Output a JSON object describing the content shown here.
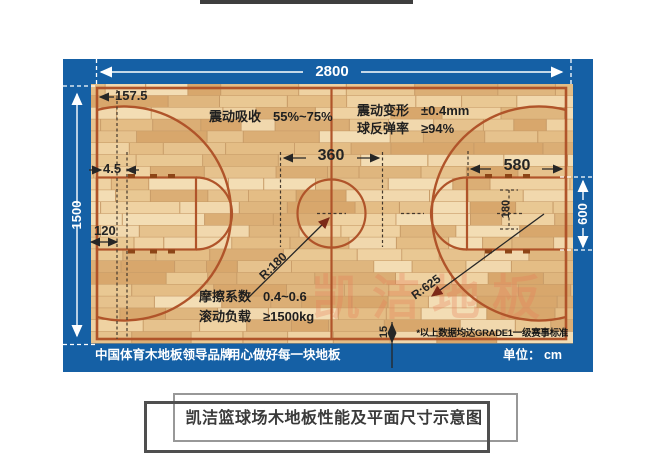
{
  "diagram": {
    "dimensions": {
      "court_length": "2800",
      "court_width": "1500",
      "baseline_to_hoop": "157.5",
      "line_gap": "4.5",
      "hoop_offset": "120",
      "center_circle_diameter": "360",
      "key_length": "580",
      "board_to_hoop": "180",
      "key_width": "600",
      "edge_gap": "15",
      "center_circle_radius": "R:180",
      "three_point_radius": "R:625"
    },
    "specs": [
      {
        "label": "震动吸收",
        "value": "55%~75%"
      },
      {
        "label": "震动变形",
        "value": "±0.4mm"
      },
      {
        "label": "球反弹率",
        "value": "≥94%"
      },
      {
        "label": "摩擦系数",
        "value": "0.4~0.6"
      },
      {
        "label": "滚动负载",
        "value": "≥1500kg"
      }
    ],
    "note": "*以上数据均达GRADE1一级赛事标准",
    "footer": {
      "brand": "中国体育木地板领导品牌",
      "slogan": "用心做好每一块地板",
      "unit": "单位： cm"
    },
    "watermark": "凯洁地板",
    "colors": {
      "frame": "#1560a5",
      "line": "#b0542a",
      "wood": "#e9c794",
      "ink": "#262626",
      "arrow_red": "#7c2a18"
    }
  },
  "caption": {
    "text": "凯洁篮球场木地板性能及平面尺寸示意图"
  }
}
